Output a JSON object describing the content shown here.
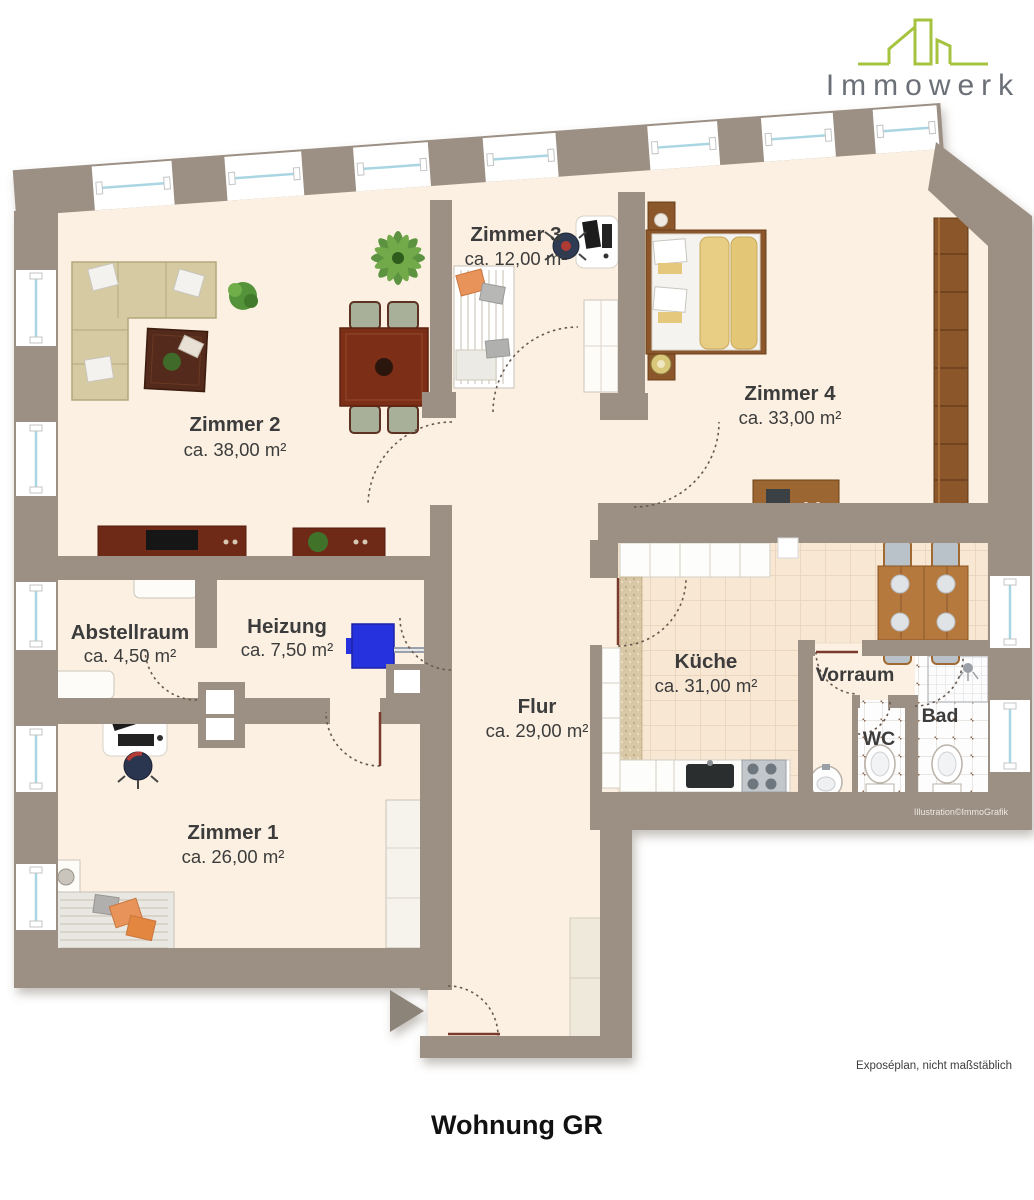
{
  "page": {
    "title": "Wohnung GR",
    "disclaimer": "Exposéplan, nicht maßstäblich",
    "credit": "Illustration©ImmoGrafik"
  },
  "logo": {
    "text": "Immowerk",
    "icon": "building-outline-icon"
  },
  "rooms": [
    {
      "name": "Zimmer 2",
      "area": "ca. 38,00 m²"
    },
    {
      "name": "Zimmer 3",
      "area": "ca. 12,00 m²"
    },
    {
      "name": "Zimmer 4",
      "area": "ca. 33,00 m²"
    },
    {
      "name": "Abstellraum",
      "area": "ca. 4,50 m²"
    },
    {
      "name": "Heizung",
      "area": "ca. 7,50 m²"
    },
    {
      "name": "Flur",
      "area": "ca. 29,00 m²"
    },
    {
      "name": "Küche",
      "area": "ca. 31,00 m²"
    },
    {
      "name": "Vorraum"
    },
    {
      "name": "WC"
    },
    {
      "name": "Bad"
    },
    {
      "name": "Zimmer 1",
      "area": "ca. 26,00 m²"
    }
  ],
  "colors": {
    "wall": "#9c8f83",
    "floor": "#fbf0e1",
    "kitchen_tile": "#f7e7d3",
    "window_glass": "#a9d6e2",
    "logo_green": "#a6c33f",
    "logo_gray": "#6b7078",
    "boiler_blue": "#2630dd",
    "door_swing": "#6a594e"
  },
  "furniture": [
    "corner-sofa",
    "coffee-table",
    "dining-table",
    "dining-chair",
    "potted-plant",
    "palm-plant",
    "tv-sideboard",
    "plant-sideboard",
    "single-bed",
    "desk",
    "office-chair",
    "wardrobe",
    "double-bed",
    "nightstand",
    "dresser",
    "kitchen-counter",
    "kitchen-sink",
    "stove",
    "kitchen-table",
    "kitchen-chair",
    "washbasin",
    "toilet",
    "shower",
    "radiator",
    "boiler",
    "hall-cabinet",
    "bed",
    "entry-arrow"
  ]
}
